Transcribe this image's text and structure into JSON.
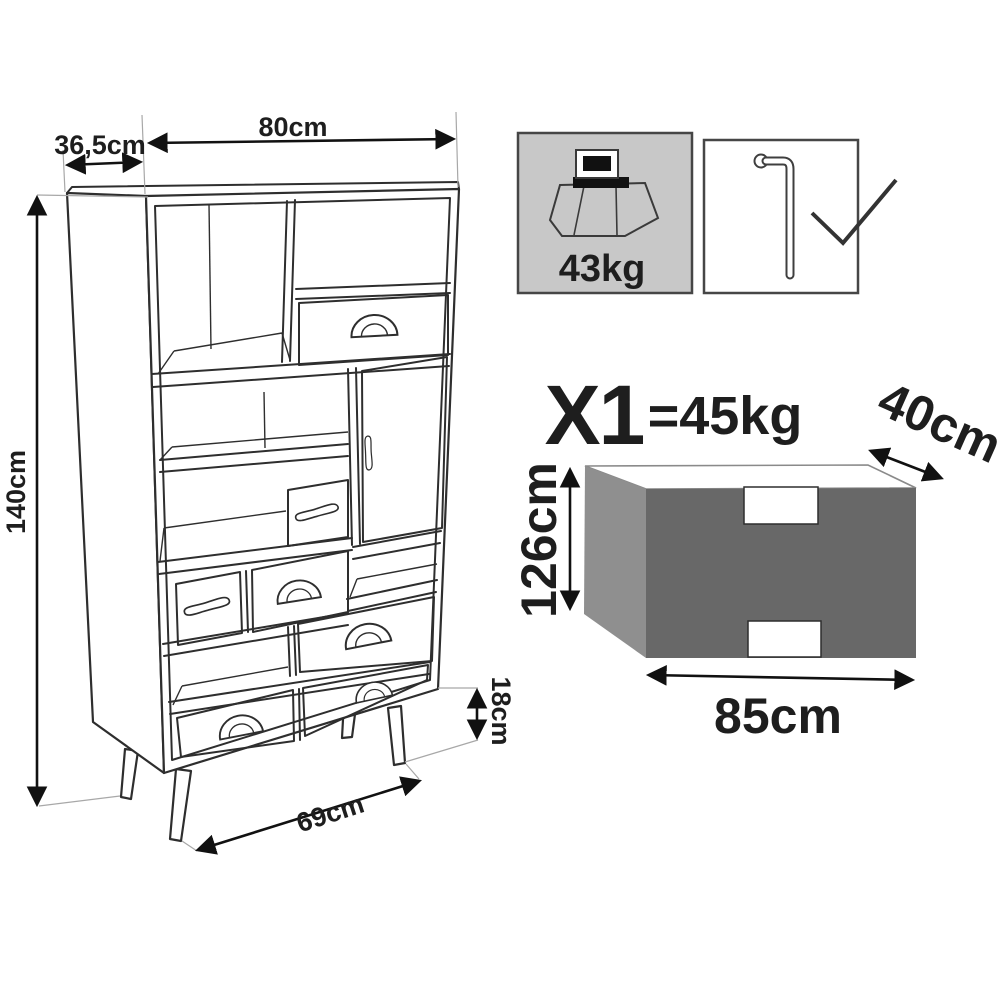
{
  "diagram_title": "furniture-assembly-dimension-sheet",
  "cabinet": {
    "dim_depth": "36,5cm",
    "dim_width": "80cm",
    "dim_height": "140cm",
    "dim_leg_height": "18cm",
    "dim_leg_span": "69cm"
  },
  "badges": {
    "max_load_value": "43kg",
    "max_load_icon": "weight-load-icon",
    "tool_icon": "allen-key-icon",
    "check_icon": "checkmark-icon"
  },
  "package": {
    "quantity": "X1",
    "weight": "=45kg",
    "dim_depth": "40cm",
    "dim_height": "126cm",
    "dim_width": "85cm"
  },
  "colors": {
    "line_art": "#2e2e2e",
    "dimension_arrows": "#111111",
    "badge_gray_fill": "#c8c8c8",
    "package_front": "#686868",
    "package_side": "#8f8f8f",
    "package_top": "#ffffff"
  }
}
